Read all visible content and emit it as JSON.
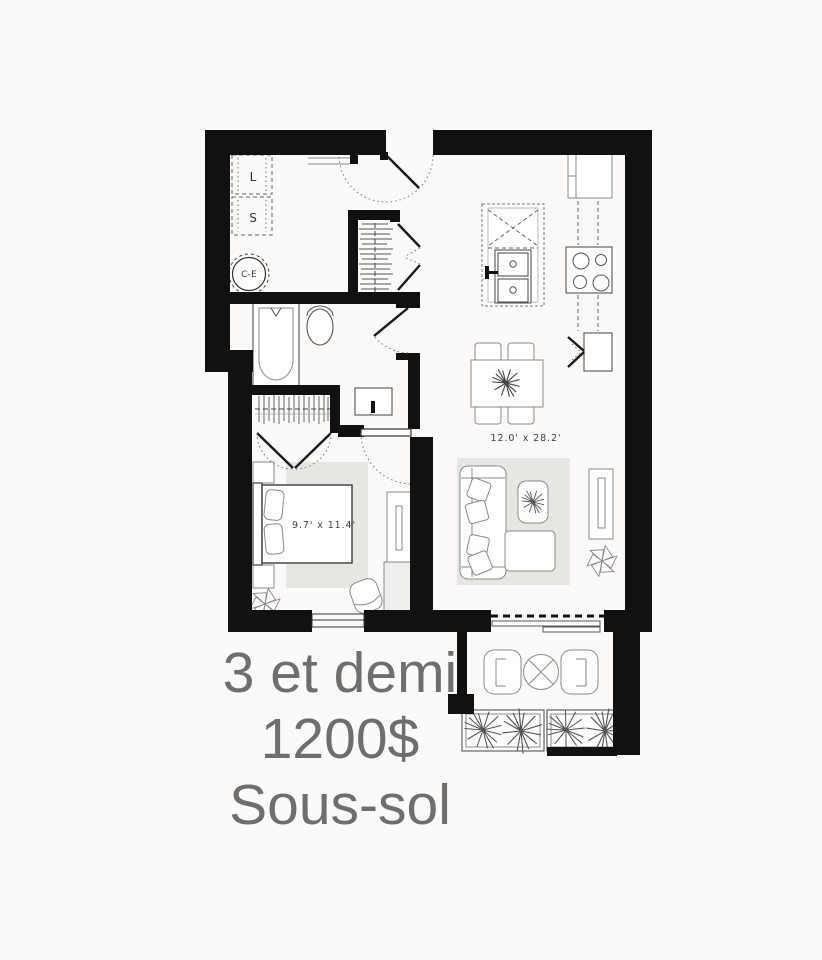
{
  "page": {
    "background_color": "#fbfaf8"
  },
  "caption": {
    "line1": "3 et demi",
    "line2": "1200$",
    "line3": "Sous-sol",
    "text_color": "#6e6e6e"
  },
  "plan": {
    "wall_color": "#111111",
    "rug_color": "#e6e6e3",
    "dimension_text_color": "#3f3f3f",
    "living_dining": {
      "dimension_label": "12.0' x 28.2'"
    },
    "bedroom": {
      "dimension_label": "9.7' x 11.4'"
    },
    "laundry": {
      "washer_label": "L",
      "dryer_label": "S",
      "water_heater_label": "C-E"
    },
    "fixtures": [
      "washer",
      "dryer",
      "water-heater",
      "entry-door",
      "entry-closet-hangers",
      "kitchen-island",
      "double-sink",
      "dishwasher",
      "refrigerator",
      "cooktop",
      "corner-pantry",
      "dining-table",
      "dining-chairs",
      "bathtub",
      "toilet",
      "vanity-sink",
      "hall-closet-hangers",
      "closet-double-doors",
      "bed",
      "nightstands",
      "dresser",
      "bedroom-chair",
      "sectional-sofa",
      "throw-pillows",
      "coffee-table",
      "tv-console",
      "potted-plants",
      "patio-sliding-door",
      "bedroom-window",
      "balcony-chairs",
      "balcony-round-table",
      "planter-boxes"
    ]
  }
}
